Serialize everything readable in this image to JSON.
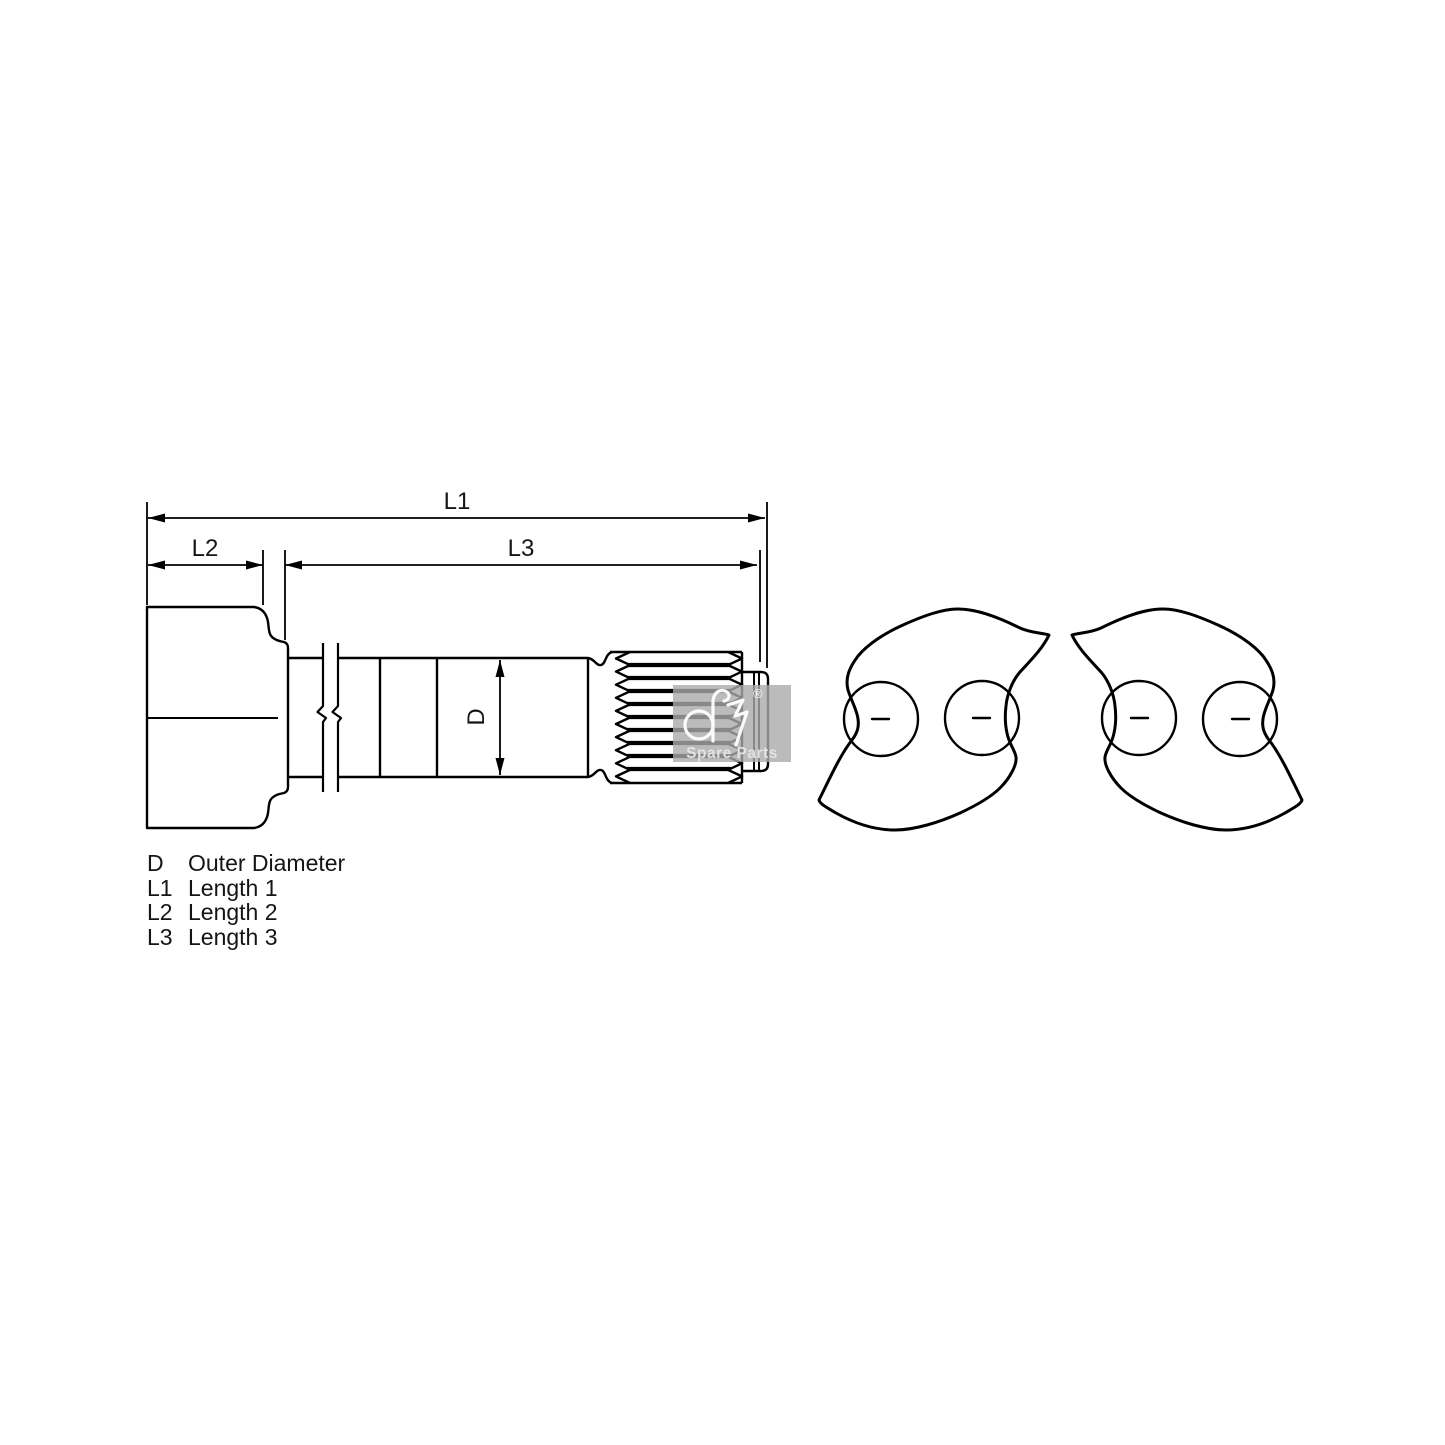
{
  "page": {
    "background": "#ffffff",
    "line_color": "#000000"
  },
  "drawing": {
    "labels": {
      "l1": "L1",
      "l2": "L2",
      "l3": "L3",
      "d": "D"
    }
  },
  "legend": {
    "rows": [
      {
        "symbol": "D",
        "label": "Outer Diameter"
      },
      {
        "symbol": "L1",
        "label": "Length 1"
      },
      {
        "symbol": "L2",
        "label": "Length 2"
      },
      {
        "symbol": "L3",
        "label": "Length 3"
      }
    ]
  },
  "watermark": {
    "registered": "®",
    "caption": "Spare Parts",
    "box_color": "#aaaaaa",
    "logo_color": "#ffffff"
  }
}
